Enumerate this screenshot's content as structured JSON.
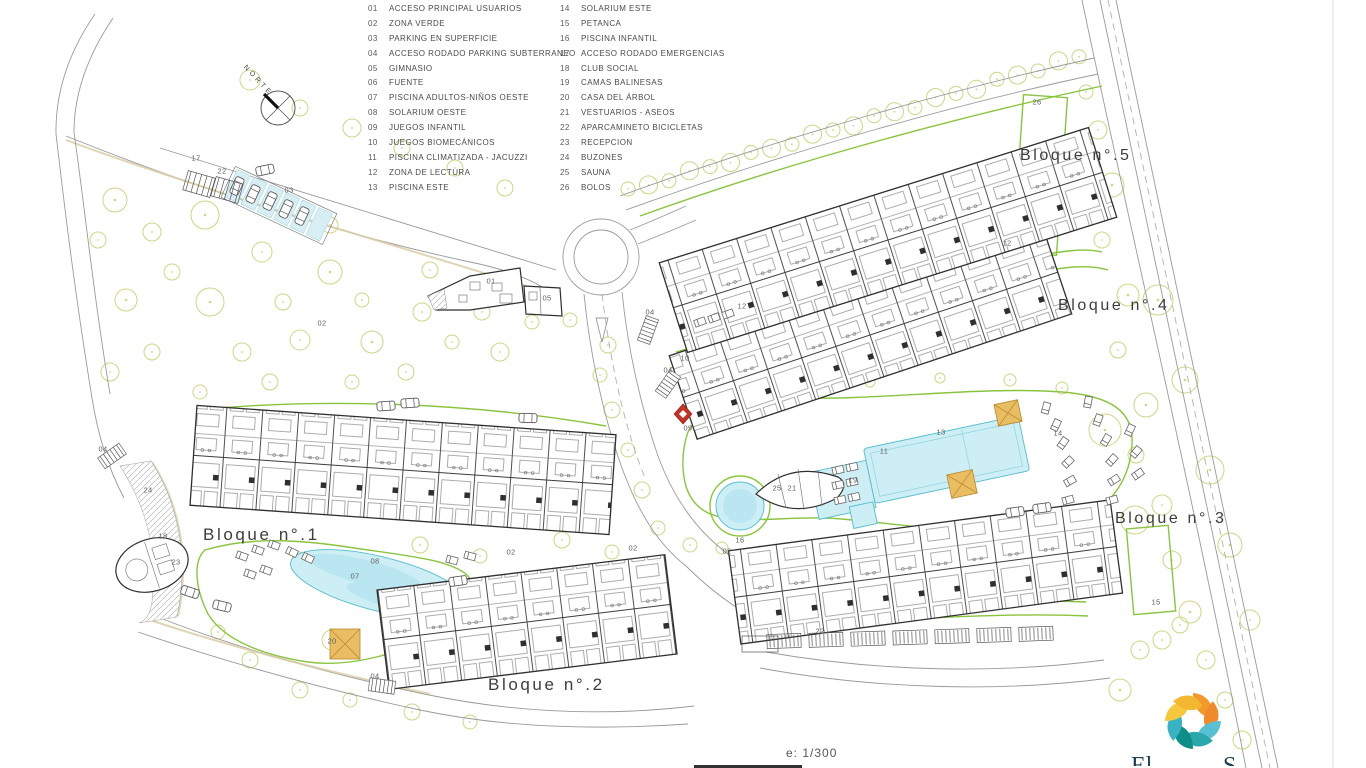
{
  "colors": {
    "green": "#8ac43f",
    "pool": "#cdeef5",
    "poolI": "#b9e6f0",
    "poolS": "#54bccd",
    "tree": "#cfd487",
    "road": "#9a9a9a",
    "bld": "#2f2f2f",
    "orange": "#e9bd62",
    "red": "#c23427",
    "txt": "#4a4a4a",
    "tan": "#d9cda6"
  },
  "north": {
    "label": "NORTE"
  },
  "scale": {
    "label": "e: 1/300"
  },
  "legend": {
    "col1": [
      {
        "num": "01",
        "label": "ACCESO PRINCIPAL USUARIOS"
      },
      {
        "num": "02",
        "label": "ZONA VERDE"
      },
      {
        "num": "03",
        "label": "PARKING EN SUPERFICIE"
      },
      {
        "num": "04",
        "label": "ACCESO RODADO PARKING SUBTERRANEO"
      },
      {
        "num": "05",
        "label": "GIMNASIO"
      },
      {
        "num": "06",
        "label": "FUENTE"
      },
      {
        "num": "07",
        "label": "PISCINA ADULTOS-NIÑOS OESTE"
      },
      {
        "num": "08",
        "label": "SOLARIUM OESTE"
      },
      {
        "num": "09",
        "label": "JUEGOS INFANTIL"
      },
      {
        "num": "10",
        "label": "JUEGOS BIOMECÁNICOS"
      },
      {
        "num": "11",
        "label": "PISCINA CLIMATIZADA - JACUZZI"
      },
      {
        "num": "12",
        "label": "ZONA DE LECTURA"
      },
      {
        "num": "13",
        "label": "PISCINA ESTE"
      }
    ],
    "col2": [
      {
        "num": "14",
        "label": "SOLARIUM ESTE"
      },
      {
        "num": "15",
        "label": "PETANCA"
      },
      {
        "num": "16",
        "label": "PISCINA INFANTIL"
      },
      {
        "num": "17",
        "label": "ACCESO RODADO EMERGENCIAS"
      },
      {
        "num": "18",
        "label": "CLUB SOCIAL"
      },
      {
        "num": "19",
        "label": "CAMAS BALINESAS"
      },
      {
        "num": "20",
        "label": "CASA DEL ÁRBOL"
      },
      {
        "num": "21",
        "label": "VESTUARIOS - ASEOS"
      },
      {
        "num": "22",
        "label": "APARCAMINETO BICICLETAS"
      },
      {
        "num": "23",
        "label": "RECEPCION"
      },
      {
        "num": "24",
        "label": "BUZONES"
      },
      {
        "num": "25",
        "label": "SAUNA"
      },
      {
        "num": "26",
        "label": "BOLOS"
      }
    ]
  },
  "blocks": [
    {
      "label": "Bloque n°.1",
      "x": 203,
      "y": 525,
      "size": 17
    },
    {
      "label": "Bloque n°.2",
      "x": 488,
      "y": 675,
      "size": 17
    },
    {
      "label": "Bloque n°.3",
      "x": 1115,
      "y": 510,
      "size": 16
    },
    {
      "label": "Bloque n°.4",
      "x": 1058,
      "y": 297,
      "size": 16
    },
    {
      "label": "Bloque n°.5",
      "x": 1020,
      "y": 147,
      "size": 16
    }
  ],
  "markers": [
    {
      "num": "17",
      "x": 196,
      "y": 158
    },
    {
      "num": "22",
      "x": 222,
      "y": 171
    },
    {
      "num": "03",
      "x": 289,
      "y": 190
    },
    {
      "num": "02",
      "x": 322,
      "y": 323
    },
    {
      "num": "01",
      "x": 491,
      "y": 281
    },
    {
      "num": "05",
      "x": 547,
      "y": 298
    },
    {
      "num": "04",
      "x": 650,
      "y": 312
    },
    {
      "num": "04",
      "x": 668,
      "y": 370
    },
    {
      "num": "10",
      "x": 685,
      "y": 358
    },
    {
      "num": "12",
      "x": 742,
      "y": 306
    },
    {
      "num": "12",
      "x": 1007,
      "y": 243
    },
    {
      "num": "09",
      "x": 688,
      "y": 428
    },
    {
      "num": "16",
      "x": 740,
      "y": 540
    },
    {
      "num": "25",
      "x": 777,
      "y": 488
    },
    {
      "num": "21",
      "x": 792,
      "y": 488
    },
    {
      "num": "19",
      "x": 853,
      "y": 480
    },
    {
      "num": "11",
      "x": 884,
      "y": 451
    },
    {
      "num": "13",
      "x": 941,
      "y": 432
    },
    {
      "num": "14",
      "x": 1058,
      "y": 433
    },
    {
      "num": "26",
      "x": 1037,
      "y": 102
    },
    {
      "num": "24",
      "x": 148,
      "y": 490
    },
    {
      "num": "18",
      "x": 163,
      "y": 536
    },
    {
      "num": "23",
      "x": 176,
      "y": 562
    },
    {
      "num": "08",
      "x": 375,
      "y": 561
    },
    {
      "num": "07",
      "x": 355,
      "y": 576
    },
    {
      "num": "20",
      "x": 332,
      "y": 641
    },
    {
      "num": "02",
      "x": 511,
      "y": 552
    },
    {
      "num": "02",
      "x": 633,
      "y": 548
    },
    {
      "num": "02",
      "x": 727,
      "y": 551
    },
    {
      "num": "22",
      "x": 820,
      "y": 631
    },
    {
      "num": "15",
      "x": 1156,
      "y": 602
    },
    {
      "num": "04",
      "x": 103,
      "y": 449
    },
    {
      "num": "04",
      "x": 375,
      "y": 676
    }
  ],
  "logo": {
    "petal_colors": [
      "#f2992b",
      "#ef8b2c",
      "#58c0d2",
      "#2aa7ab",
      "#0f8e88",
      "#39b2c3",
      "#f5c840",
      "#f4b731"
    ],
    "partial_text_left": "El",
    "partial_text_right": "S"
  }
}
